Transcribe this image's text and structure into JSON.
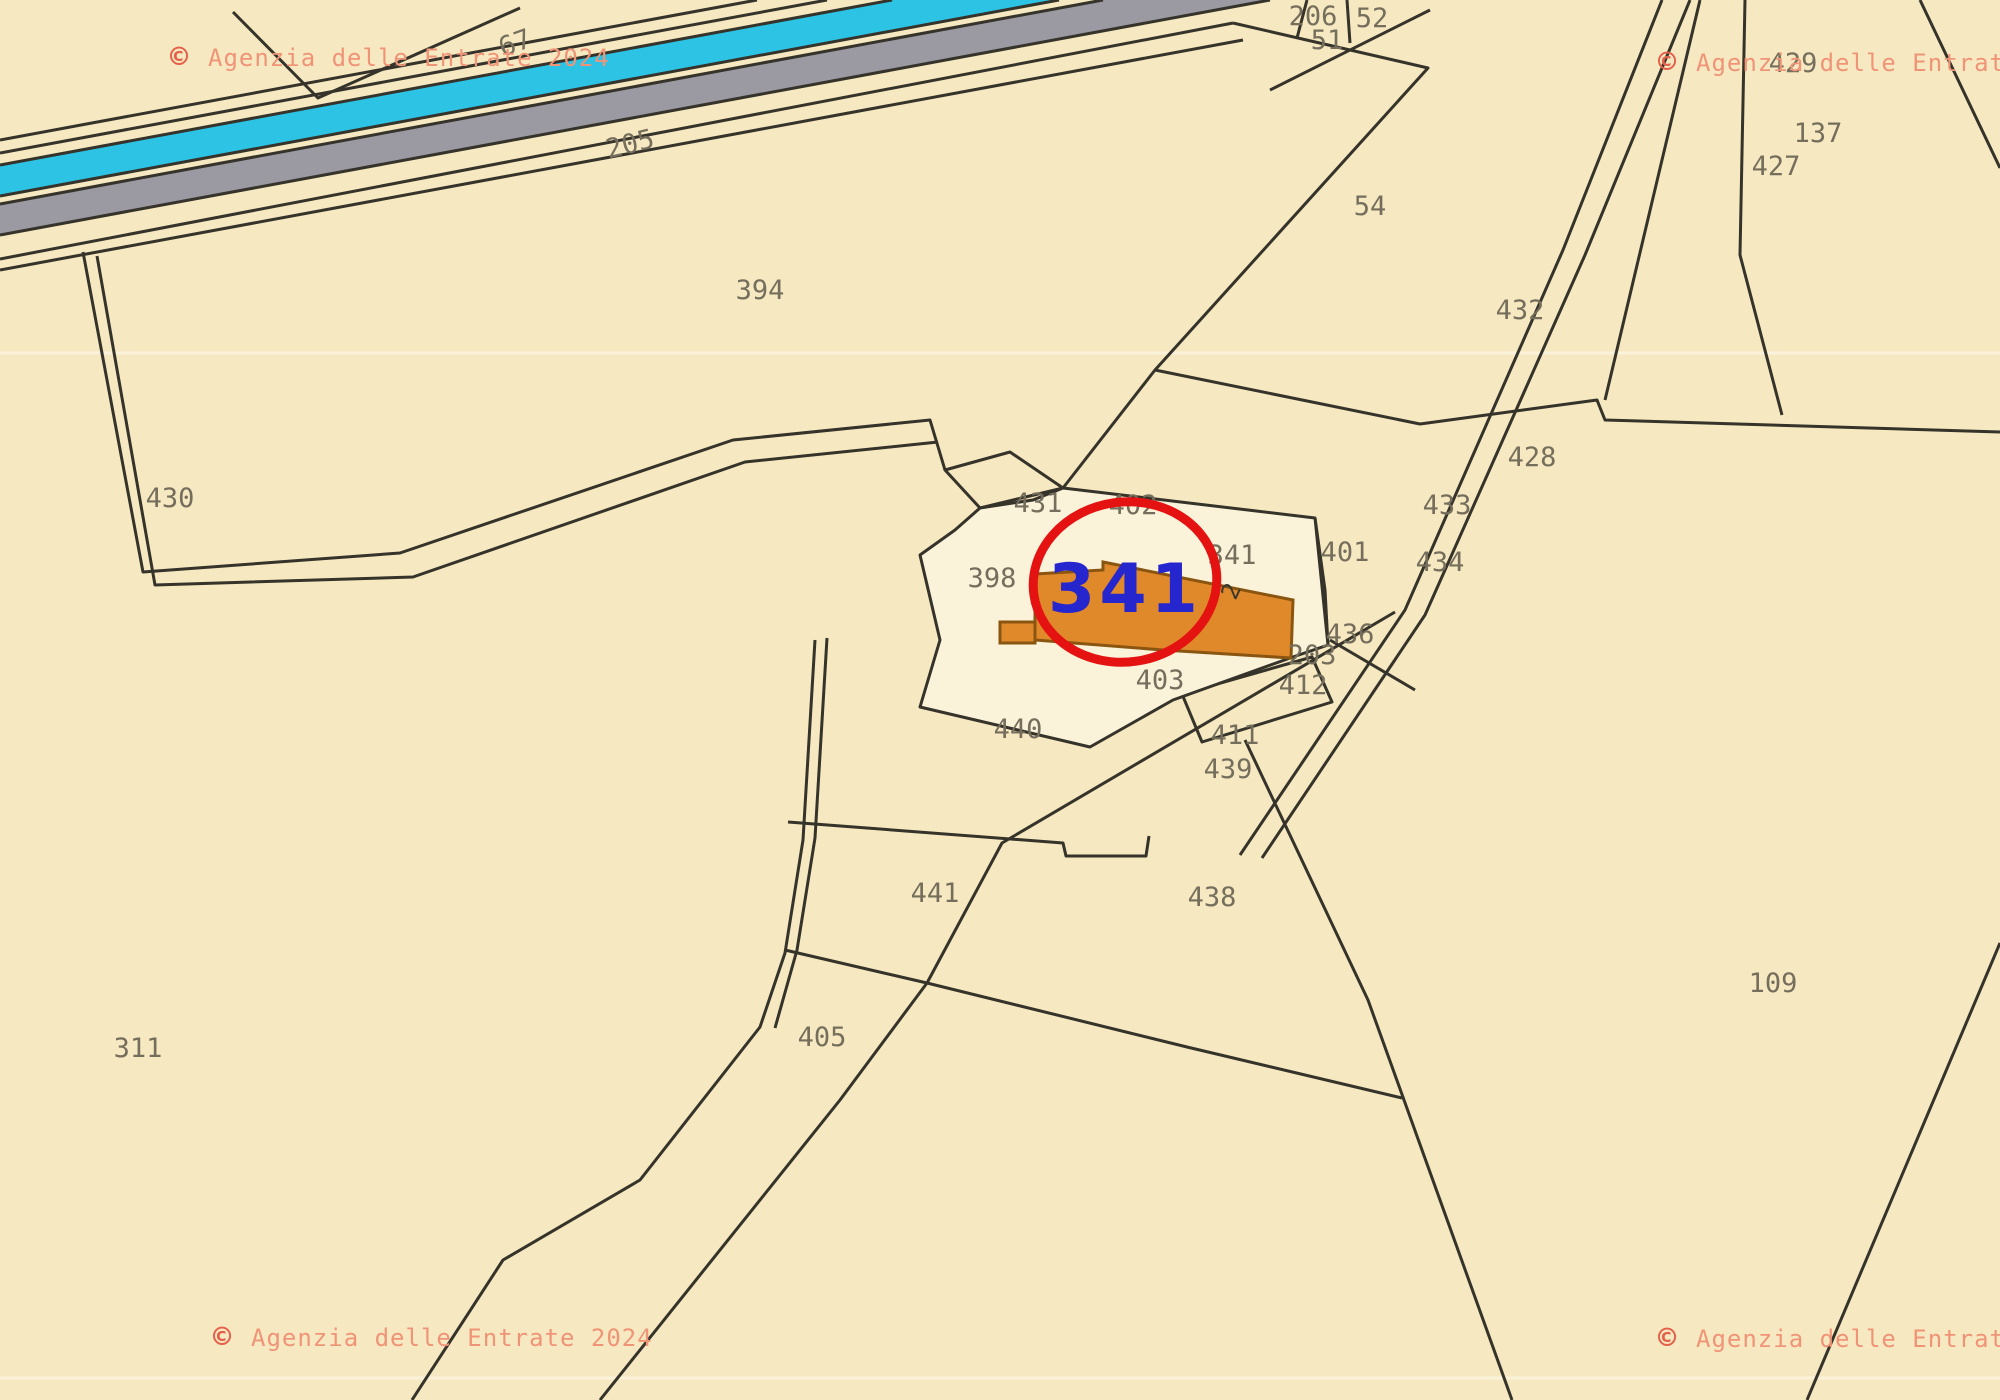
{
  "map": {
    "title": "Cadastral map extract (Agenzia delle Entrate)",
    "copyright_full": "© Agenzia delle Entrate 2024",
    "copyright_symbol": "©",
    "copyright_text": "Agenzia delle Entrate 2024"
  },
  "colors": {
    "background_paper": "#f6e9c1",
    "parcel_light_fill": "#faf2d9",
    "boundary_line": "#35332a",
    "water_band_cyan": "#2cc3e5",
    "road_band_gray": "#9b99a1",
    "watermark_salmon": "#f09478",
    "watermark_copyright_red": "#e4604a",
    "highlight_blue": "#2626ce",
    "highlight_circle_red": "#e51212",
    "building_orange_fill": "#e0892b",
    "building_orange_border": "#8a5510",
    "label_gray": "#756e5c"
  },
  "highlight": {
    "parcel_number": "341",
    "floors_mark": "2",
    "cx": 1125,
    "cy": 582
  },
  "watermarks": [
    {
      "x": 170,
      "y": 57,
      "text": "Agenzia delle Entrate 2024"
    },
    {
      "x": 1658,
      "y": 62,
      "text": "Agenzia delle Entrate 2024"
    },
    {
      "x": 213,
      "y": 1337,
      "text": "Agenzia delle Entrate 2024"
    },
    {
      "x": 1658,
      "y": 1338,
      "text": "Agenzia delle Entrate 2024"
    }
  ],
  "parcels": [
    {
      "id": "67",
      "x": 515,
      "y": 43,
      "rot": -20
    },
    {
      "id": "205",
      "x": 630,
      "y": 144,
      "rot": -14
    },
    {
      "id": "206",
      "x": 1313,
      "y": 16,
      "rot": 0
    },
    {
      "id": "52",
      "x": 1372,
      "y": 18,
      "rot": 0
    },
    {
      "id": "51",
      "x": 1327,
      "y": 40,
      "rot": 0
    },
    {
      "id": "54",
      "x": 1370,
      "y": 206,
      "rot": 0
    },
    {
      "id": "394",
      "x": 760,
      "y": 290,
      "rot": 0
    },
    {
      "id": "429",
      "x": 1793,
      "y": 63,
      "rot": 0
    },
    {
      "id": "137",
      "x": 1818,
      "y": 133,
      "rot": 0
    },
    {
      "id": "427",
      "x": 1776,
      "y": 166,
      "rot": 0
    },
    {
      "id": "432",
      "x": 1520,
      "y": 310,
      "rot": 0
    },
    {
      "id": "428",
      "x": 1532,
      "y": 457,
      "rot": 0
    },
    {
      "id": "433",
      "x": 1447,
      "y": 505,
      "rot": 0
    },
    {
      "id": "434",
      "x": 1440,
      "y": 562,
      "rot": 0
    },
    {
      "id": "430",
      "x": 170,
      "y": 498,
      "rot": 0
    },
    {
      "id": "431",
      "x": 1038,
      "y": 503,
      "rot": 0
    },
    {
      "id": "402",
      "x": 1133,
      "y": 505,
      "rot": 0
    },
    {
      "id": "341",
      "x": 1232,
      "y": 555,
      "rot": 0
    },
    {
      "id": "401",
      "x": 1345,
      "y": 552,
      "rot": 0
    },
    {
      "id": "398",
      "x": 992,
      "y": 578,
      "rot": 0
    },
    {
      "id": "436",
      "x": 1350,
      "y": 634,
      "rot": 0
    },
    {
      "id": "203",
      "x": 1312,
      "y": 655,
      "rot": 0
    },
    {
      "id": "412",
      "x": 1303,
      "y": 685,
      "rot": 0
    },
    {
      "id": "403",
      "x": 1160,
      "y": 680,
      "rot": 0
    },
    {
      "id": "440",
      "x": 1018,
      "y": 729,
      "rot": 0
    },
    {
      "id": "411",
      "x": 1235,
      "y": 735,
      "rot": 0
    },
    {
      "id": "439",
      "x": 1228,
      "y": 769,
      "rot": 0
    },
    {
      "id": "441",
      "x": 935,
      "y": 893,
      "rot": 0
    },
    {
      "id": "438",
      "x": 1212,
      "y": 897,
      "rot": 0
    },
    {
      "id": "405",
      "x": 822,
      "y": 1037,
      "rot": 0
    },
    {
      "id": "311",
      "x": 138,
      "y": 1048,
      "rot": 0
    },
    {
      "id": "109",
      "x": 1773,
      "y": 983,
      "rot": 0
    }
  ]
}
